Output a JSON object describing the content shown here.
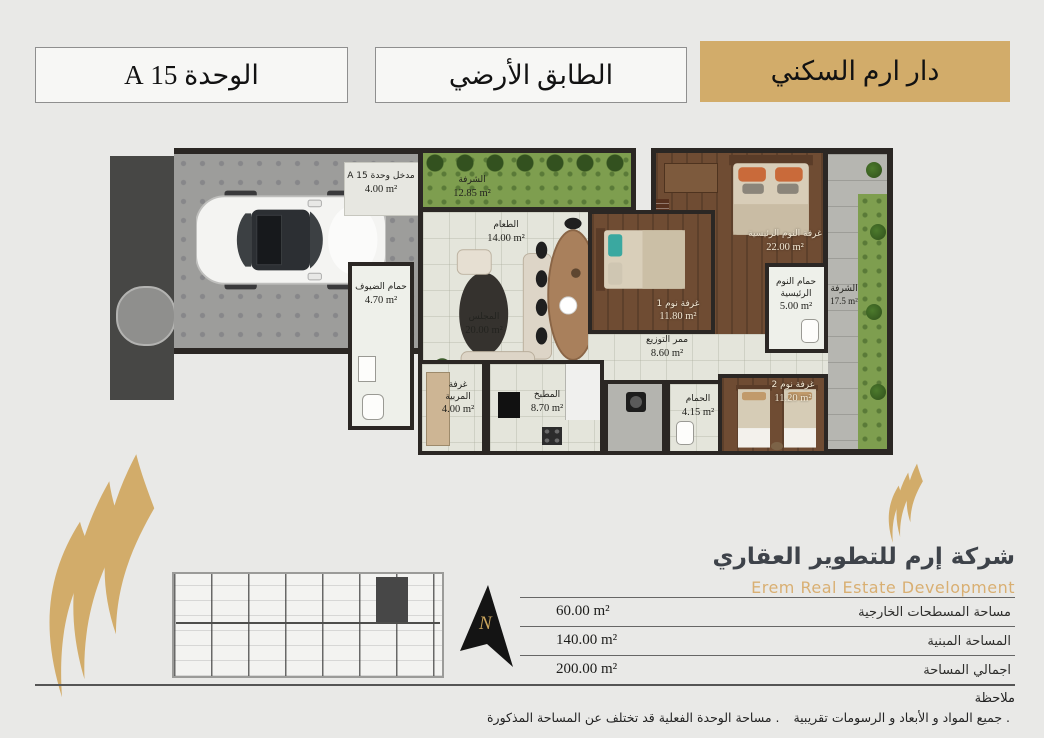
{
  "header": {
    "project": "دار ارم السكني",
    "floor": "الطابق الأرضي",
    "unit": "الوحدة 15 A"
  },
  "plan": {
    "rooms": {
      "entrance": {
        "name": "مدخل وحدة 15 A",
        "area": "4.00 m²"
      },
      "front_balcony": {
        "name": "الشرفة",
        "area": "12.85 m²"
      },
      "dining": {
        "name": "الطعام",
        "area": "14.00 m²"
      },
      "majlis": {
        "name": "المجلس",
        "area": "20.00 m²"
      },
      "guest_bathroom": {
        "name": "حمام الضيوف",
        "area": "4.70 m²"
      },
      "bedroom1": {
        "name": "غرفة نوم 1",
        "area": "11.80 m²"
      },
      "master_bedroom": {
        "name": "غرفة النوم الرئيسية",
        "area": "22.00 m²"
      },
      "side_balcony": {
        "name": "الشرفة",
        "area": "17.5 m²"
      },
      "master_bathroom": {
        "name": "حمام النوم الرئيسية",
        "area": "5.00 m²"
      },
      "corridor": {
        "name": "ممر التوزيع",
        "area": "8.60 m²"
      },
      "maid_room": {
        "name": "غرفة المربية",
        "area": "4.00 m²"
      },
      "kitchen": {
        "name": "المطبخ",
        "area": "8.70 m²"
      },
      "bathroom": {
        "name": "الحمام",
        "area": "4.15 m²"
      },
      "bedroom2": {
        "name": "غرفة نوم 2",
        "area": "11.20 m²"
      }
    }
  },
  "company": {
    "name_ar": "شركة إرم للتطوير العقاري",
    "name_en": "Erem Real Estate Development"
  },
  "areas_table": {
    "rows": [
      {
        "label": "مساحة المسطحات الخارجية",
        "value": "60.00 m²"
      },
      {
        "label": "المساحة المبنية",
        "value": "140.00 m²"
      },
      {
        "label": "اجمالي المساحة",
        "value": "200.00 m²"
      }
    ]
  },
  "notes": {
    "title": "ملاحظة",
    "items": [
      ". جميع المواد و الأبعاد و الرسومات تقريبية",
      ". مساحة الوحدة الفعلية قد تختلف عن المساحة المذكورة"
    ]
  },
  "compass": {
    "north": "N"
  },
  "colors": {
    "gold": "#d2ac6a",
    "wall": "#2b2724",
    "wood": "#6f4c33",
    "grass": "#7e9e4f"
  }
}
